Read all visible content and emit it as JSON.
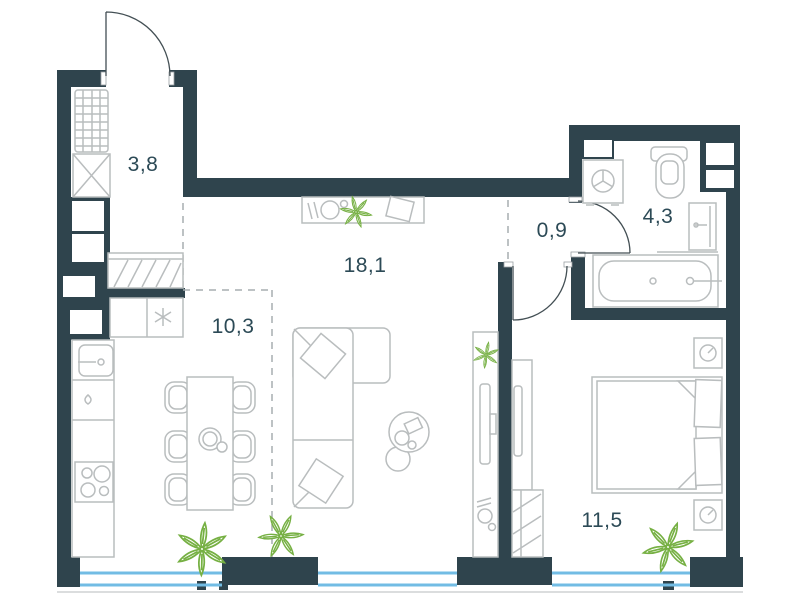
{
  "plan": {
    "type": "apartment-floor-plan",
    "rooms": [
      {
        "name": "entry-storage",
        "area_label": "3,8"
      },
      {
        "name": "kitchen-dining",
        "area_label": "10,3"
      },
      {
        "name": "living-room",
        "area_label": "18,1"
      },
      {
        "name": "corridor",
        "area_label": "0,9"
      },
      {
        "name": "bathroom",
        "area_label": "4,3"
      },
      {
        "name": "bedroom",
        "area_label": "11,5"
      }
    ],
    "colors": {
      "wall": "#2f444d",
      "furniture_line": "#b9bdbe",
      "plant": "#76b043",
      "window": "#72bce4",
      "label_text": "#2c4a56",
      "door_line": "#434f54",
      "zone_dash": "#a7aeb0"
    },
    "symbols": [
      "entry-door",
      "shelving-unit",
      "laundry-box",
      "hatched-wardrobe",
      "kitchen-counter",
      "kitchen-sink",
      "hob",
      "dining-table",
      "chairs",
      "corner-sofa",
      "coffee-table",
      "console-table",
      "tv",
      "plants",
      "double-bed",
      "nightstands",
      "bedroom-wardrobe",
      "washing-machine",
      "toilet",
      "bathroom-sink",
      "bathtub",
      "windows",
      "door-arcs"
    ]
  }
}
